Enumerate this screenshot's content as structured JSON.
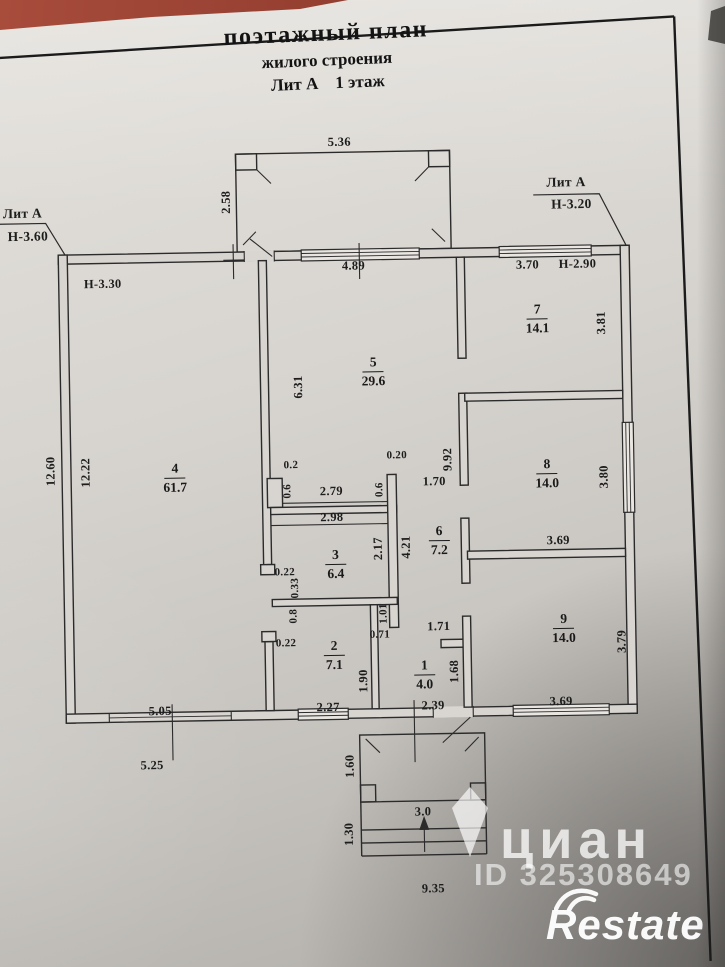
{
  "document": {
    "title_line1": "поэтажный план",
    "title_line2": "жилого строения",
    "title_line3": "Лит А    1 этаж"
  },
  "plan": {
    "rooms": [
      {
        "num": "1",
        "area": "4.0",
        "x": 421,
        "y": 676
      },
      {
        "num": "2",
        "area": "7.1",
        "x": 331,
        "y": 655
      },
      {
        "num": "3",
        "area": "6.4",
        "x": 334,
        "y": 564
      },
      {
        "num": "4",
        "area": "61.7",
        "x": 175,
        "y": 475
      },
      {
        "num": "5",
        "area": "29.6",
        "x": 375,
        "y": 372
      },
      {
        "num": "6",
        "area": "7.2",
        "x": 438,
        "y": 542
      },
      {
        "num": "7",
        "area": "14.1",
        "x": 540,
        "y": 322
      },
      {
        "num": "8",
        "area": "14.0",
        "x": 547,
        "y": 477
      },
      {
        "num": "9",
        "area": "14.0",
        "x": 561,
        "y": 632
      }
    ],
    "dimensions": [
      {
        "t": "Лит А",
        "x": 27,
        "y": 208,
        "cls": "callout"
      },
      {
        "t": "Н-3.60",
        "x": 32,
        "y": 231,
        "cls": "callout"
      },
      {
        "t": "Лит А",
        "x": 571,
        "y": 186,
        "cls": "callout"
      },
      {
        "t": "Н-3.20",
        "x": 576,
        "y": 208,
        "cls": "callout"
      },
      {
        "t": "Н-3.30",
        "x": 106,
        "y": 280
      },
      {
        "t": "Н-2.90",
        "x": 581,
        "y": 268
      },
      {
        "t": "5.36",
        "x": 345,
        "y": 142
      },
      {
        "t": "2.58",
        "x": 231,
        "y": 200,
        "v": 1
      },
      {
        "t": "4.89",
        "x": 357,
        "y": 266
      },
      {
        "t": "3.70",
        "x": 531,
        "y": 268
      },
      {
        "t": "6.31",
        "x": 300,
        "y": 386,
        "v": 1
      },
      {
        "t": "9.92",
        "x": 448,
        "y": 461,
        "v": 1
      },
      {
        "t": "3.81",
        "x": 604,
        "y": 327,
        "v": 1
      },
      {
        "t": "12.60",
        "x": 51,
        "y": 466,
        "v": 1
      },
      {
        "t": "12.22",
        "x": 86,
        "y": 468,
        "v": 1
      },
      {
        "t": "0.2",
        "x": 291,
        "y": 464,
        "s": 1
      },
      {
        "t": "0.6",
        "x": 287,
        "y": 490,
        "v": 1,
        "s": 1
      },
      {
        "t": "2.79",
        "x": 331,
        "y": 491
      },
      {
        "t": "0.20",
        "x": 397,
        "y": 456,
        "s": 1
      },
      {
        "t": "0.6",
        "x": 379,
        "y": 490,
        "v": 1,
        "s": 1
      },
      {
        "t": "1.70",
        "x": 434,
        "y": 483
      },
      {
        "t": "2.98",
        "x": 331,
        "y": 517
      },
      {
        "t": "3.80",
        "x": 604,
        "y": 481,
        "v": 1
      },
      {
        "t": "2.17",
        "x": 377,
        "y": 549,
        "v": 1
      },
      {
        "t": "4.21",
        "x": 405,
        "y": 548,
        "v": 1
      },
      {
        "t": "3.69",
        "x": 557,
        "y": 544
      },
      {
        "t": "0.22",
        "x": 283,
        "y": 571,
        "s": 1
      },
      {
        "t": "0.33",
        "x": 293,
        "y": 587,
        "v": 1,
        "s": 1
      },
      {
        "t": "0.8",
        "x": 291,
        "y": 615,
        "v": 1,
        "s": 1
      },
      {
        "t": "1.01",
        "x": 381,
        "y": 614,
        "v": 1,
        "s": 1
      },
      {
        "t": "0.22",
        "x": 283,
        "y": 642,
        "s": 1
      },
      {
        "t": "0.71",
        "x": 377,
        "y": 635,
        "s": 1
      },
      {
        "t": "1.71",
        "x": 436,
        "y": 628
      },
      {
        "t": "1.90",
        "x": 360,
        "y": 681,
        "v": 1
      },
      {
        "t": "1.68",
        "x": 451,
        "y": 673,
        "v": 1
      },
      {
        "t": "3.79",
        "x": 619,
        "y": 646,
        "v": 1
      },
      {
        "t": "5.05",
        "x": 156,
        "y": 708
      },
      {
        "t": "2.27",
        "x": 324,
        "y": 707
      },
      {
        "t": "2.39",
        "x": 429,
        "y": 707
      },
      {
        "t": "3.69",
        "x": 557,
        "y": 705
      },
      {
        "t": "5.25",
        "x": 147,
        "y": 762
      },
      {
        "t": "1.60",
        "x": 345,
        "y": 766,
        "v": 1
      },
      {
        "t": "3.0",
        "x": 417,
        "y": 813
      },
      {
        "t": "1.30",
        "x": 343,
        "y": 834,
        "v": 1
      },
      {
        "t": "9.35",
        "x": 426,
        "y": 890
      }
    ]
  },
  "watermarks": {
    "cian": "циан",
    "cian_id": "ID 325308649",
    "restate": "Restate"
  },
  "colors": {
    "paper": "#d8d5d0",
    "ink": "#222222",
    "photo_edge_red": "#9c4335",
    "watermark_white": "#ffffff"
  }
}
